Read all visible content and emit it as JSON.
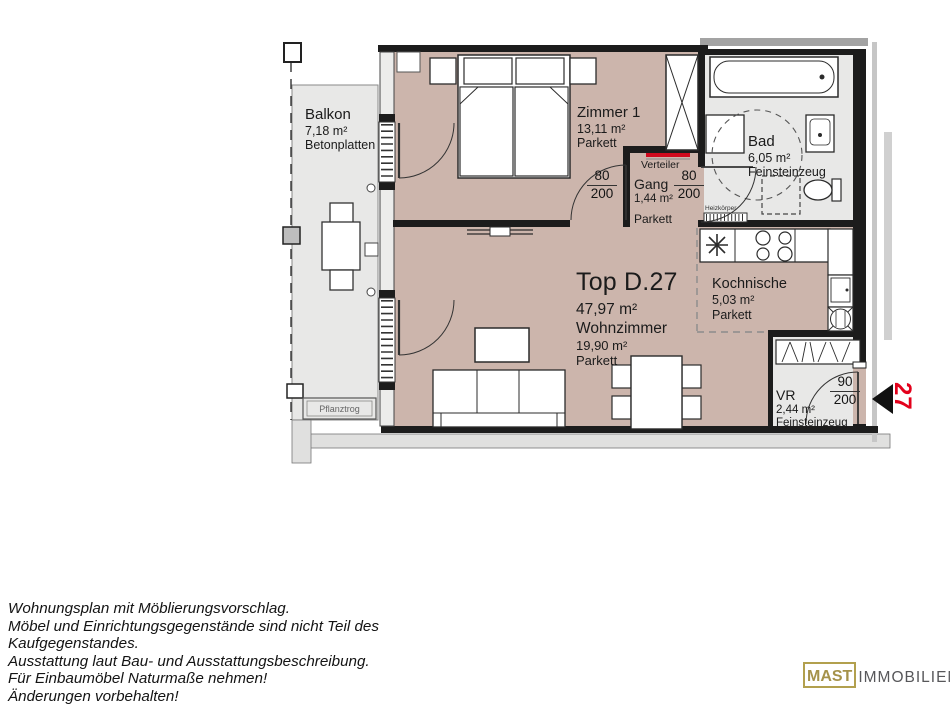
{
  "plan": {
    "balcony": {
      "name": "Balkon",
      "area": "7,18 m²",
      "finish": "Betonplatten",
      "planter_label": "Pflanztrog"
    },
    "bedroom": {
      "name": "Zimmer 1",
      "area": "13,11 m²",
      "finish": "Parkett"
    },
    "distributor_label": "Verteiler",
    "hall": {
      "name": "Gang",
      "area": "1,44 m²",
      "finish": "Parkett"
    },
    "bathroom": {
      "name": "Bad",
      "area": "6,05 m²",
      "finish": "Feinsteinzeug",
      "radiator_label": "Heizkörper"
    },
    "unit": {
      "title": "Top D.27",
      "total_area": "47,97 m²"
    },
    "living": {
      "name": "Wohnzimmer",
      "area": "19,90 m²",
      "finish": "Parkett"
    },
    "kitchen": {
      "name": "Kochnische",
      "area": "5,03 m²",
      "finish": "Parkett"
    },
    "vestibule": {
      "name": "VR",
      "area": "2,44 m²",
      "finish": "Feinsteinzeug"
    },
    "doors": {
      "bedroom_door": {
        "width": "80",
        "height": "200"
      },
      "bath_door": {
        "width": "80",
        "height": "200"
      },
      "entry_door": {
        "width": "90",
        "height": "200"
      }
    },
    "entrance_number": "27"
  },
  "footer": {
    "lines": [
      "Wohnungsplan mit Möblierungsvorschlag.",
      "Möbel und Einrichtungsgegenstände sind nicht Teil des",
      "Kaufgegenstandes.",
      "Ausstattung laut Bau- und Ausstattungsbeschreibung.",
      "Für Einbaumöbel Naturmaße nehmen!",
      "Änderungen vorbehalten!"
    ]
  },
  "logo": {
    "brand": "MAST",
    "suffix": "IMMOBILIEN"
  },
  "colors": {
    "room_fill": "#ccb5ac",
    "wet_room_fill": "#e8e8e7",
    "wall_black": "#1c1c1c",
    "accent_red": "#e3001b",
    "verteiler_red": "#cf0a1e",
    "logo_gold": "#b2a04e",
    "logo_gray": "#57575a"
  }
}
